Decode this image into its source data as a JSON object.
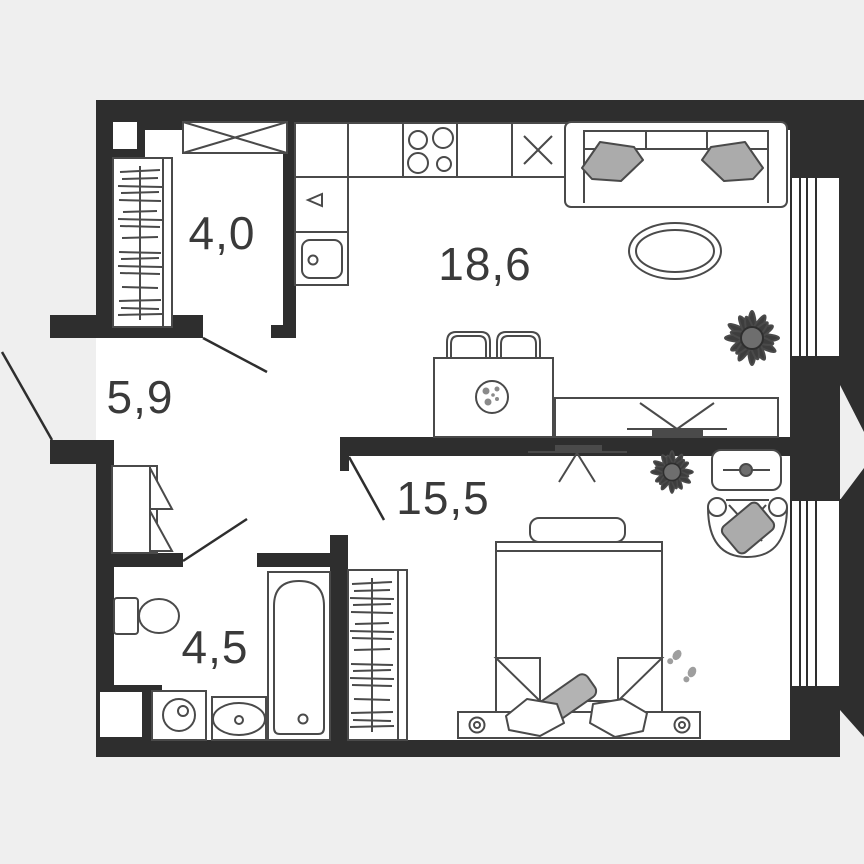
{
  "plan": {
    "type": "apartment-floor-plan",
    "rooms": [
      {
        "name": "dressing-room",
        "area_label": "4,0"
      },
      {
        "name": "hallway",
        "area_label": "5,9"
      },
      {
        "name": "kitchen-living-room",
        "area_label": "18,6"
      },
      {
        "name": "bedroom",
        "area_label": "15,5"
      },
      {
        "name": "bathroom",
        "area_label": "4,5"
      }
    ],
    "colors": {
      "background": "#efefef",
      "floor": "#ffffff",
      "walls": "#2e2e2e",
      "furniture_line": "#4a4a4a",
      "soft_gray": "#ababab",
      "plant_dark": "#3d3d3d",
      "label_text": "#3a3a3a"
    },
    "window_count": 2,
    "door_count": 4,
    "furniture": {
      "dressing_room": [
        "shelf-unit",
        "clothes-rail"
      ],
      "hallway": [
        "shoe-cabinet"
      ],
      "kitchen_living": [
        "kitchen-counter",
        "hob",
        "fridge",
        "faucet",
        "kitchen-sink",
        "sofa",
        "sofa-pillows",
        "coffee-table",
        "plant",
        "bar-table",
        "stools",
        "plate",
        "tv-console",
        "tv"
      ],
      "bedroom": [
        "tv",
        "plant",
        "ac-unit",
        "armchair",
        "bench",
        "double-bed",
        "pillows",
        "nightstand-lamps",
        "slippers",
        "wardrobe"
      ],
      "bathroom": [
        "toilet",
        "washing-machine",
        "wash-basin",
        "bathtub"
      ]
    }
  }
}
